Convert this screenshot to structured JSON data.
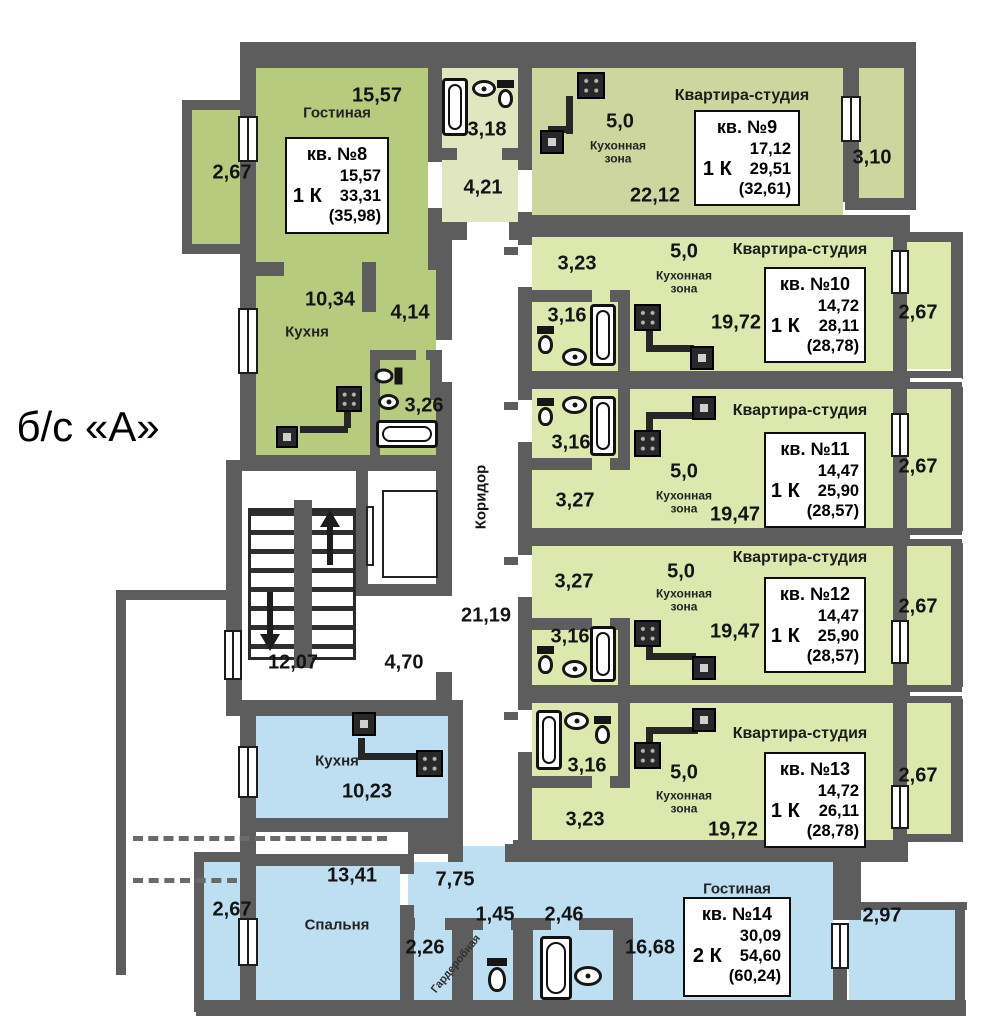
{
  "section_label": "б/с «А»",
  "colors": {
    "wall": "#5d5d5d",
    "apt8": "#b6cb7d",
    "apt9": "#ccd69e",
    "pale": "#dfe6c0",
    "studio": "#dce8ae",
    "blue": "#bedef2"
  },
  "common": {
    "corridor": {
      "label": "Коридор",
      "area": "21,19"
    },
    "stairwell": {
      "area": "12,07"
    },
    "elevator_hall": {
      "area": "4,70"
    }
  },
  "apartments": {
    "a8": {
      "info": {
        "number": "кв. №8",
        "rooms": "1 К",
        "living": "15,57",
        "total": "33,31",
        "total_with_balcony": "(35,98)"
      },
      "living": {
        "name": "Гостиная",
        "area": "15,57"
      },
      "kitchen": {
        "name": "Кухня",
        "area": "10,34"
      },
      "hall_top": {
        "area": "4,21"
      },
      "hall_inner": {
        "area": "4,14"
      },
      "bathroom_top": {
        "area": "3,18"
      },
      "bathroom_inner": {
        "area": "3,26"
      },
      "balcony": {
        "area": "2,67"
      }
    },
    "a9": {
      "type_label": "Квартира-студия",
      "info": {
        "number": "кв. №9",
        "rooms": "1 К",
        "living": "17,12",
        "total": "29,51",
        "total_with_balcony": "(32,61)"
      },
      "kitchen_zone": {
        "name": "Кухонная зона",
        "area": "5,0"
      },
      "main": {
        "area": "22,12"
      },
      "balcony": {
        "area": "3,10"
      }
    },
    "a10": {
      "type_label": "Квартира-студия",
      "info": {
        "number": "кв. №10",
        "rooms": "1 К",
        "living": "14,72",
        "total": "28,11",
        "total_with_balcony": "(28,78)"
      },
      "hall": {
        "area": "3,23"
      },
      "kitchen_zone": {
        "name": "Кухонная зона",
        "area": "5,0"
      },
      "main": {
        "area": "19,72"
      },
      "bathroom": {
        "area": "3,16"
      },
      "balcony": {
        "area": "2,67"
      }
    },
    "a11": {
      "type_label": "Квартира-студия",
      "info": {
        "number": "кв. №11",
        "rooms": "1 К",
        "living": "14,47",
        "total": "25,90",
        "total_with_balcony": "(28,57)"
      },
      "hall": {
        "area": "3,27"
      },
      "kitchen_zone": {
        "name": "Кухонная зона",
        "area": "5,0"
      },
      "main": {
        "area": "19,47"
      },
      "bathroom": {
        "area": "3,16"
      },
      "balcony": {
        "area": "2,67"
      }
    },
    "a12": {
      "type_label": "Квартира-студия",
      "info": {
        "number": "кв. №12",
        "rooms": "1 К",
        "living": "14,47",
        "total": "25,90",
        "total_with_balcony": "(28,57)"
      },
      "hall": {
        "area": "3,27"
      },
      "kitchen_zone": {
        "name": "Кухонная зона",
        "area": "5,0"
      },
      "main": {
        "area": "19,47"
      },
      "bathroom": {
        "area": "3,16"
      },
      "balcony": {
        "area": "2,67"
      }
    },
    "a13": {
      "type_label": "Квартира-студия",
      "info": {
        "number": "кв. №13",
        "rooms": "1 К",
        "living": "14,72",
        "total": "26,11",
        "total_with_balcony": "(28,78)"
      },
      "hall": {
        "area": "3,23"
      },
      "kitchen_zone": {
        "name": "Кухонная зона",
        "area": "5,0"
      },
      "main": {
        "area": "19,72"
      },
      "bathroom": {
        "area": "3,16"
      },
      "balcony": {
        "area": "2,67"
      }
    },
    "a14": {
      "info": {
        "number": "кв. №14",
        "rooms": "2 К",
        "living": "30,09",
        "total": "54,60",
        "total_with_balcony": "(60,24)"
      },
      "kitchen": {
        "name": "Кухня",
        "area": "10,23"
      },
      "bedroom": {
        "name": "Спальня",
        "area": "13,41"
      },
      "hall": {
        "area": "7,75"
      },
      "wardrobe": {
        "name": "Гардеробная",
        "area": "2,26"
      },
      "wc": {
        "area": "1,45"
      },
      "bathroom": {
        "area": "2,46"
      },
      "living": {
        "name": "Гостиная",
        "area": "16,68"
      },
      "balcony_right": {
        "area": "2,97"
      },
      "balcony_left": {
        "area": "2,67"
      }
    }
  }
}
